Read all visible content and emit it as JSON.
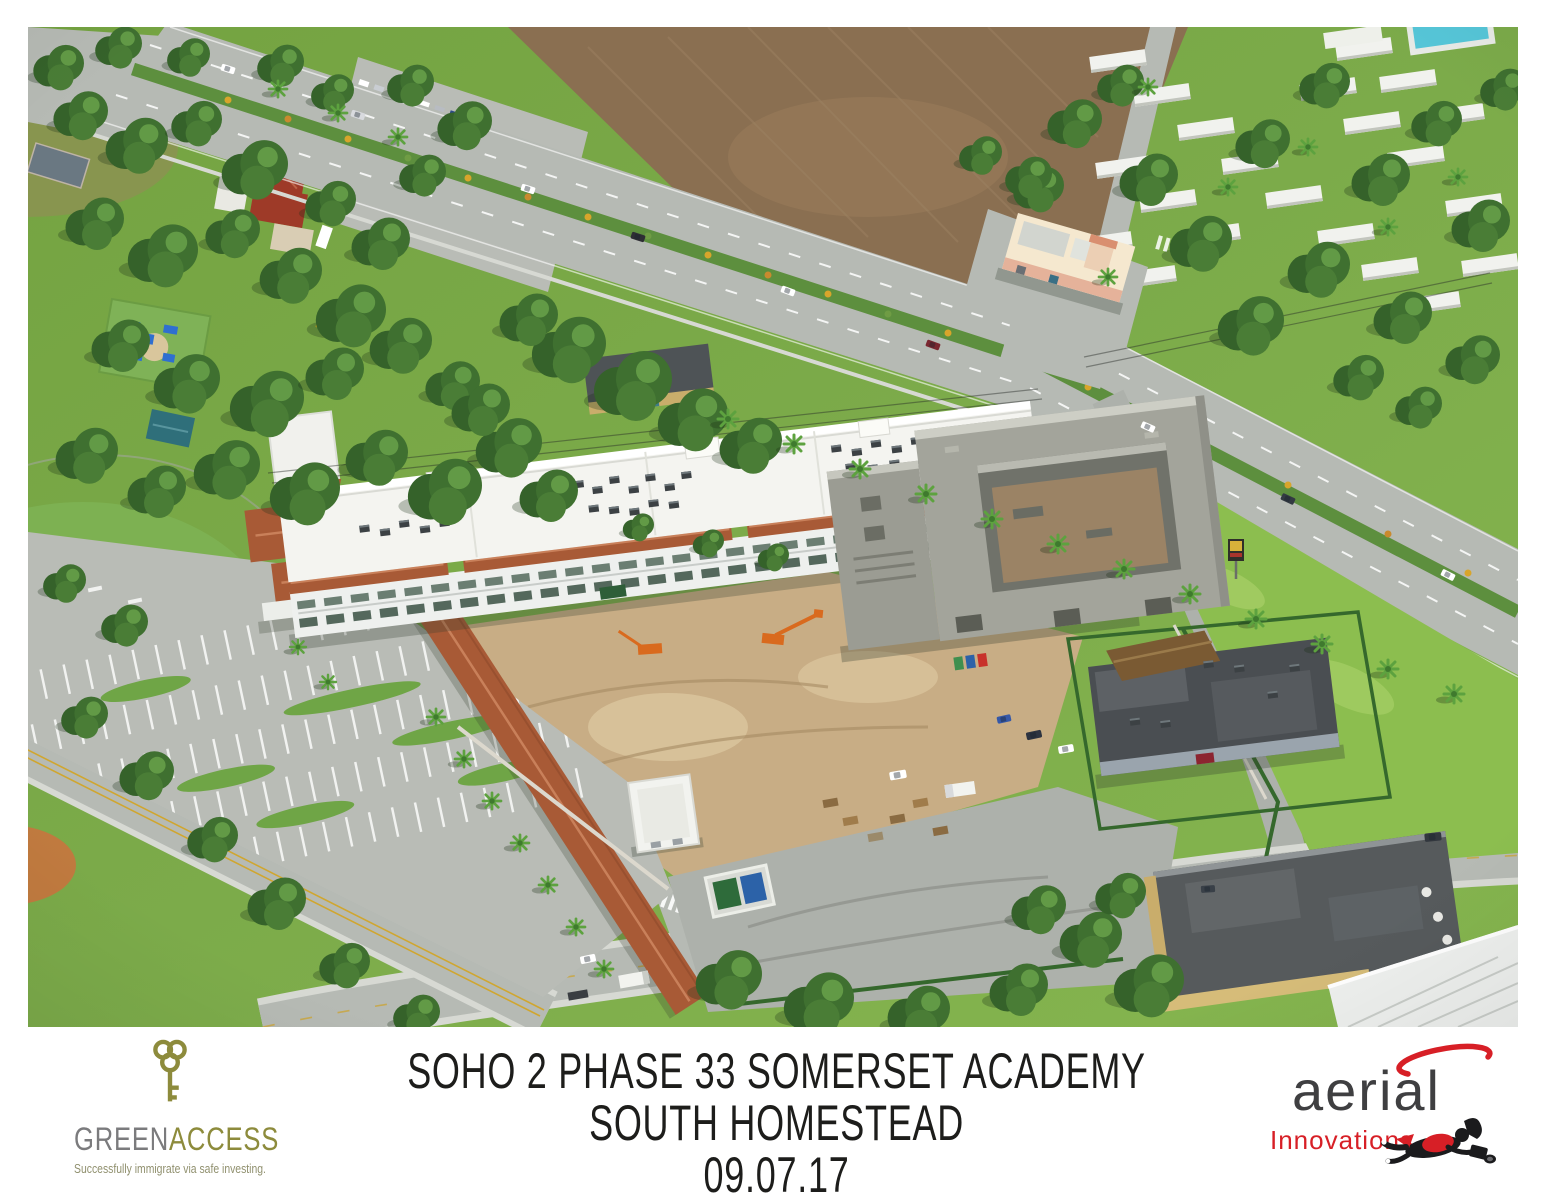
{
  "photo": {
    "alt": "Oblique aerial photograph of the SOHO 2 Phase 33 Somerset Academy construction site in South Homestead: a white two-story school with terracotta tile roofs and a long terracotta covered walkway, a gray concrete building shell under construction, sandy dirt work areas with construction equipment, an empty landscaped parking lot, a divided highway lined with palms, a plowed farm field, a city park with ball field, and a mobile home community."
  },
  "caption": {
    "line1": "SOHO 2 PHASE 33 SOMERSET ACADEMY",
    "line2": "SOUTH HOMESTEAD",
    "date": "09.07.17"
  },
  "logos": {
    "greenaccess": {
      "word_green": "GREEN",
      "word_access": "ACCESS",
      "tagline": "Successfully immigrate via safe investing."
    },
    "aerial_innovations": {
      "word_primary": "aerial",
      "word_secondary": "Innovations"
    }
  },
  "colors": {
    "caption_text": "#1d1d1b",
    "brand_olive": "#8d8b3c",
    "brand_gray": "#7b7b7d",
    "brand_olive_soft": "#90906e",
    "brand_red": "#d71f26",
    "brand_charcoal": "#3f3f41",
    "grass_light": "#8cbe4f",
    "grass": "#7aa747",
    "grass_dark": "#699e3d",
    "road": "#b6bab4",
    "road_dark": "#adb1ab",
    "sidewalk": "#d7d9d3",
    "median_green": "#5d8f3e",
    "dirt_field": "#8a6f51",
    "dirt_field_light": "#a0835f",
    "dirt_site": "#c8ad85",
    "dirt_site_light": "#dbc69e",
    "roof_white": "#f4f4f0",
    "wall_white": "#eceeea",
    "terracotta": "#a85a36",
    "terracotta_light": "#c9805a",
    "concrete": "#a3a49b",
    "concrete_dark": "#70726a",
    "fence_green": "#35682c",
    "wall_light": "#dcd8cd",
    "tree_dark": "#35622a",
    "tree": "#3f7030",
    "tree_mid": "#4a7d36",
    "tree_light": "#6fa84e",
    "palm_frond": "#5da23f",
    "asphalt": "#b9bcb6",
    "pool_water": "#56c6d8",
    "tan_wall": "#c9ad6b",
    "roof_dark": "#565a5c",
    "cream": "#f5e8cf",
    "peach": "#e5b29a",
    "machine_orange": "#d96a1e",
    "bush_yellow": "#d8a52b",
    "infield_clay": "#c07a3f",
    "court_blue": "#3f6f9e",
    "playground_blue": "#2f6fd0",
    "pavilion_teal": "#2f6f7a",
    "pavilion_red": "#9e3a28"
  }
}
